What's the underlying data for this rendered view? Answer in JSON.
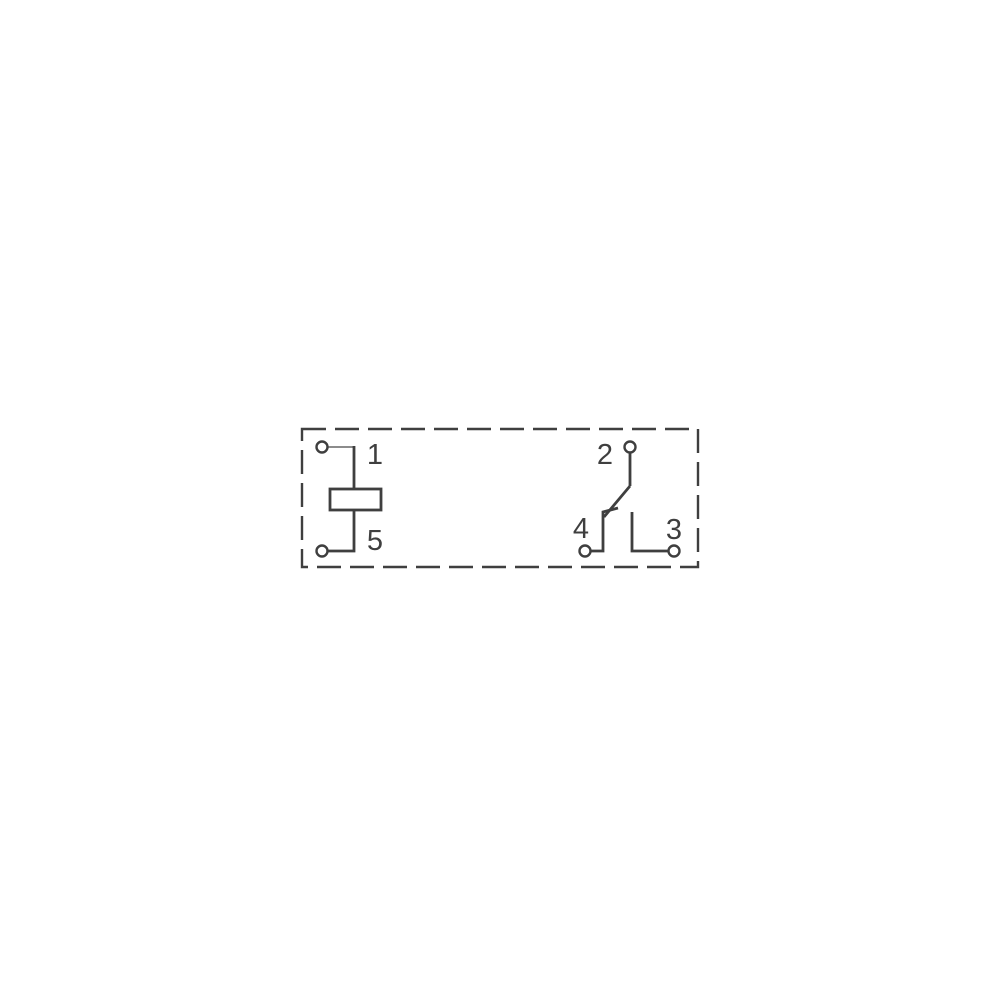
{
  "colors": {
    "bg": "#ffffff",
    "stroke": "#3f3f3f",
    "lead_light": "#8c8c8c",
    "terminal_fill": "#ffffff"
  },
  "diagram": {
    "type": "relay-pinout-schematic",
    "outline_style": "dashed",
    "pin_labels": {
      "pin1": "1",
      "pin2": "2",
      "pin3": "3",
      "pin4": "4",
      "pin5": "5"
    },
    "semantics": {
      "coil_between": [
        "1",
        "5"
      ],
      "switch_common": "2",
      "switch_normally_closed": "4",
      "switch_normally_open": "3"
    }
  }
}
